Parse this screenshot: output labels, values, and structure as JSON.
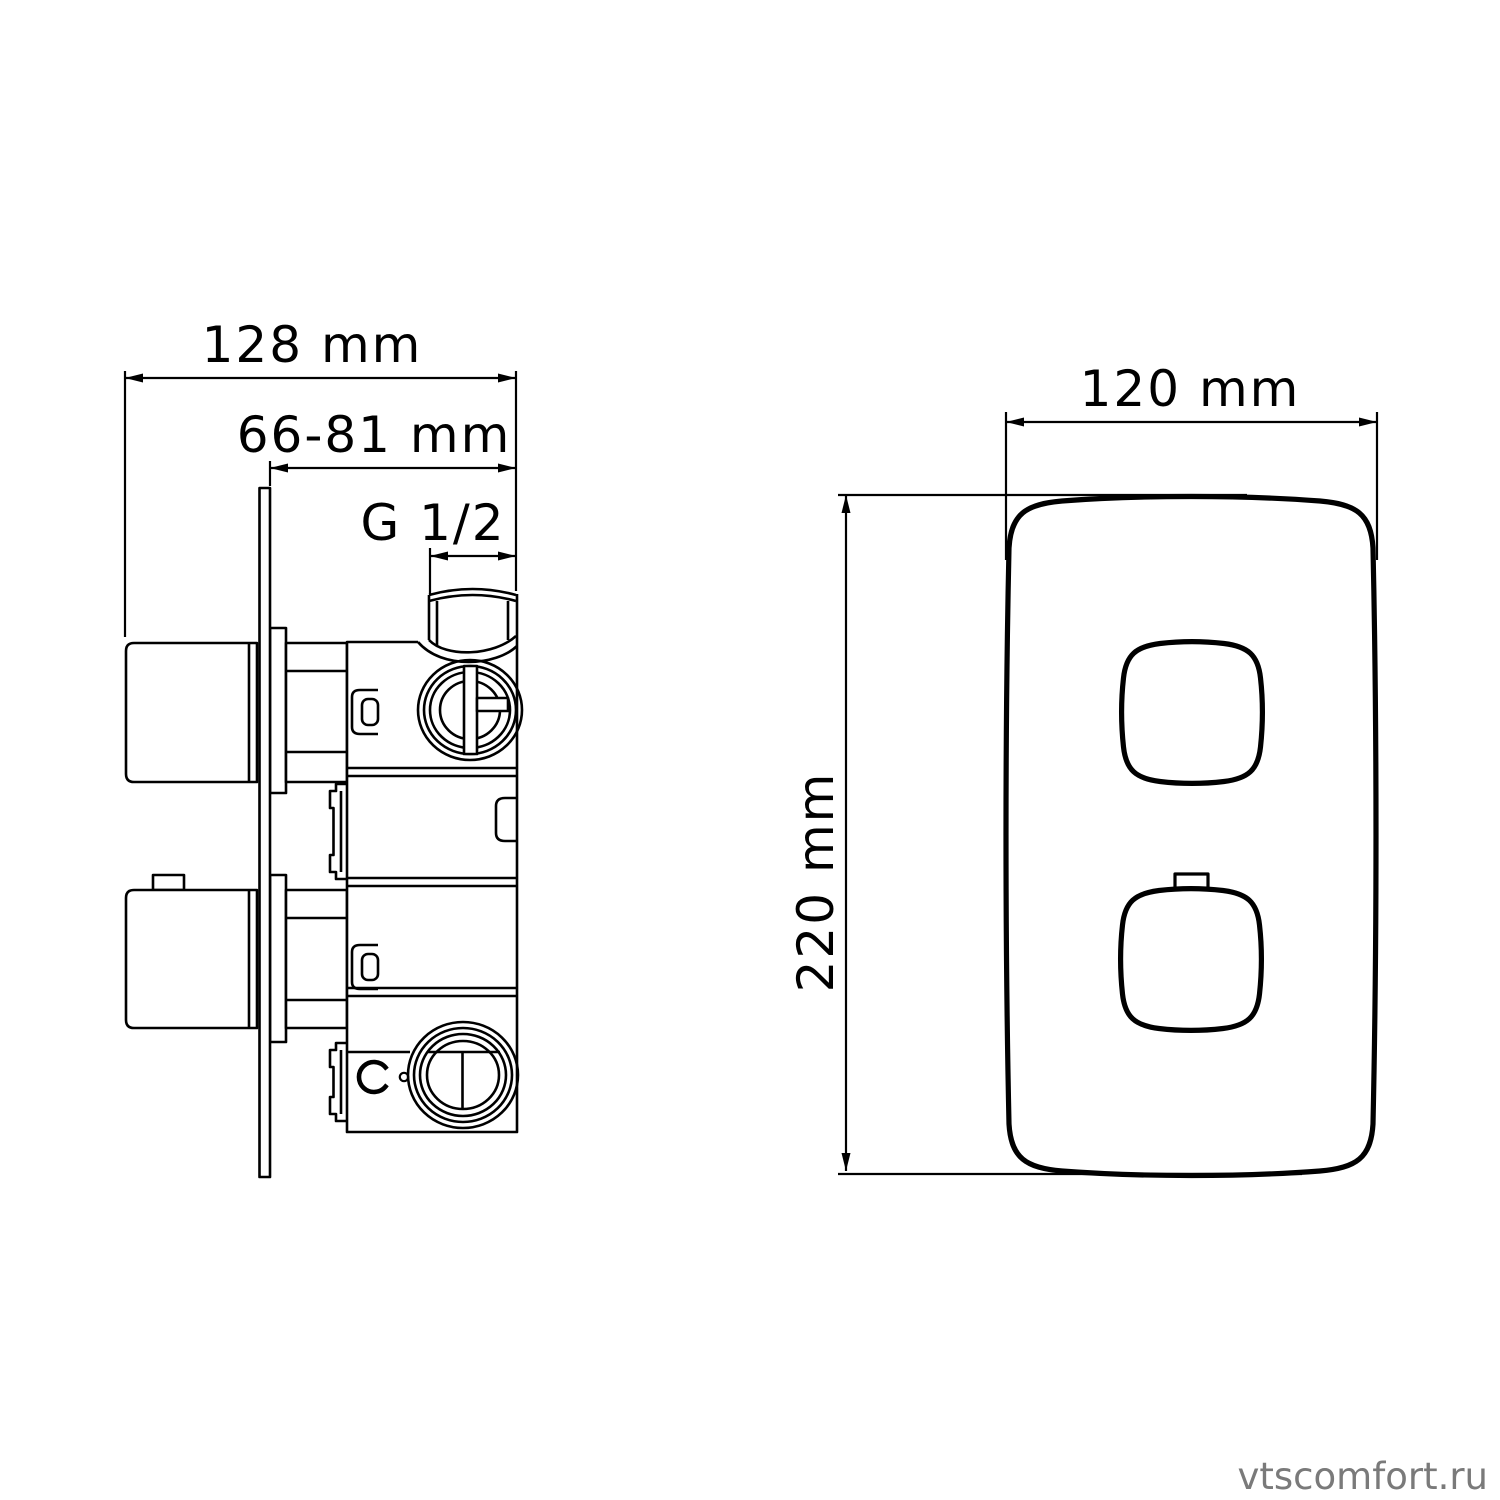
{
  "drawing": {
    "line_color": "#000000",
    "background_color": "#ffffff",
    "side_view": {
      "dim_overall_depth_label": "128 mm",
      "dim_wall_depth_range_label": "66-81 mm",
      "thread_size_label": "G 1/2"
    },
    "front_view": {
      "dim_width_label": "120 mm",
      "dim_height_label": "220 mm"
    }
  },
  "watermark": {
    "text": "vtscomfort.ru",
    "color": "#7a7a7a"
  }
}
